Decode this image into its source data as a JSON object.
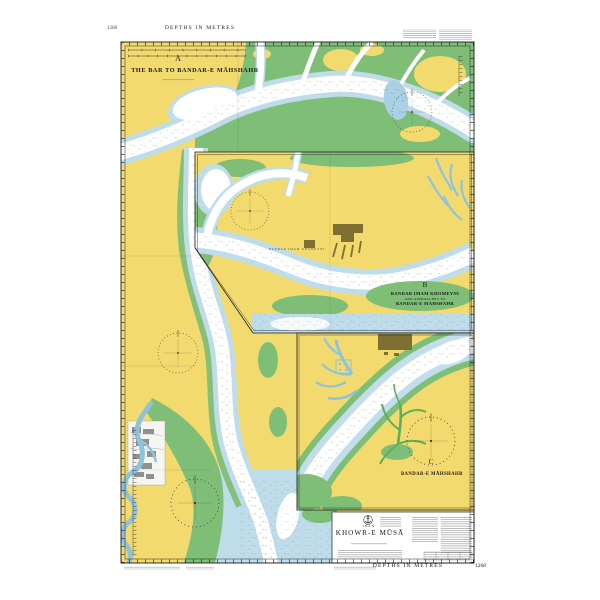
{
  "margins": {
    "top": {
      "chart_number": "1268",
      "depths_label": "DEPTHS IN METRES"
    },
    "bottom": {
      "depths_label": "DEPTHS IN METRES",
      "chart_number": "1268"
    }
  },
  "panel_a": {
    "letter": "A",
    "title": "THE BAR TO BANDAR-E MĀHSHAHR"
  },
  "panel_b": {
    "letter": "B",
    "title_line1": "BANDAR IMAM KHOMEYNI",
    "title_line2": "AND APPROACHES TO",
    "title_line3": "BANDAR-E MĀHSHAHR",
    "land_label": "BANDAR IMAM KHOMEYNI"
  },
  "panel_c": {
    "letter": "C",
    "title": "BANDAR-E MĀHSHAHR"
  },
  "title_block": {
    "country": "IRAN",
    "title": "KHOWR-E MŪSĀ",
    "crest_icon": "anchor-icon"
  },
  "colors": {
    "land": "#F2DA6E",
    "marsh": "#7FBE77",
    "shallow_water": "#BFDCEA",
    "river": "#8FC3DC",
    "built_up": "#7E6F33",
    "paper": "#FFFFFF",
    "ink": "#1a1a1a"
  }
}
